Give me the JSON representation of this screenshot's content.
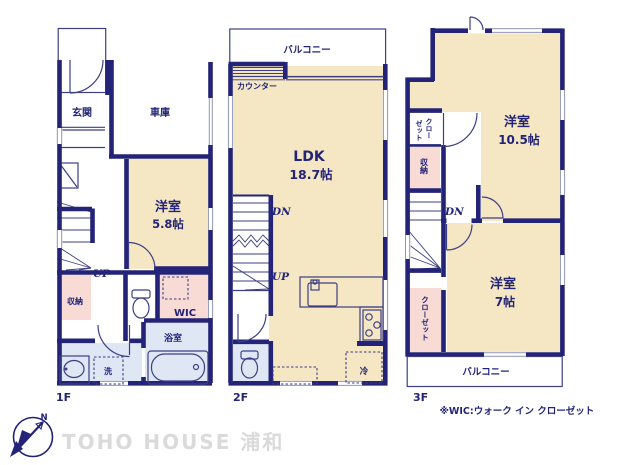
{
  "colors": {
    "wall_navy": "#232477",
    "room_beige": "#F5E7C4",
    "closet_pink": "#F8DBD4",
    "understairs_salmon": "#F6CFC6",
    "wet_area_blue": "#DEE7F3",
    "watermark_gray": "#DADADA"
  },
  "floor1": {
    "label": "1F",
    "entrance": "玄関",
    "garage": "車庫",
    "room_name": "洋室",
    "room_size": "5.8帖",
    "stairs_up": "UP",
    "storage": "収納",
    "wic": "WIC",
    "bathroom": "浴室",
    "laundry": "洗"
  },
  "floor2": {
    "label": "2F",
    "balcony": "バルコニー",
    "counter": "カウンター",
    "ldk_name": "LDK",
    "ldk_size": "18.7帖",
    "stairs_down": "DN",
    "stairs_up": "UP",
    "fridge": "冷"
  },
  "floor3": {
    "label": "3F",
    "room1_name": "洋室",
    "room1_size": "10.5帖",
    "closet_top_col1": "クロー",
    "closet_top_col2": "ゼット",
    "storage": "収納",
    "stairs_down": "DN",
    "room2_name": "洋室",
    "room2_size": "7帖",
    "closet_bottom": "クローゼット",
    "balcony": "バルコニー"
  },
  "footnote": "※WIC:ウォーク イン クローゼット",
  "watermark": "TOHO HOUSE 浦和",
  "compass": {
    "north_label": "N"
  }
}
